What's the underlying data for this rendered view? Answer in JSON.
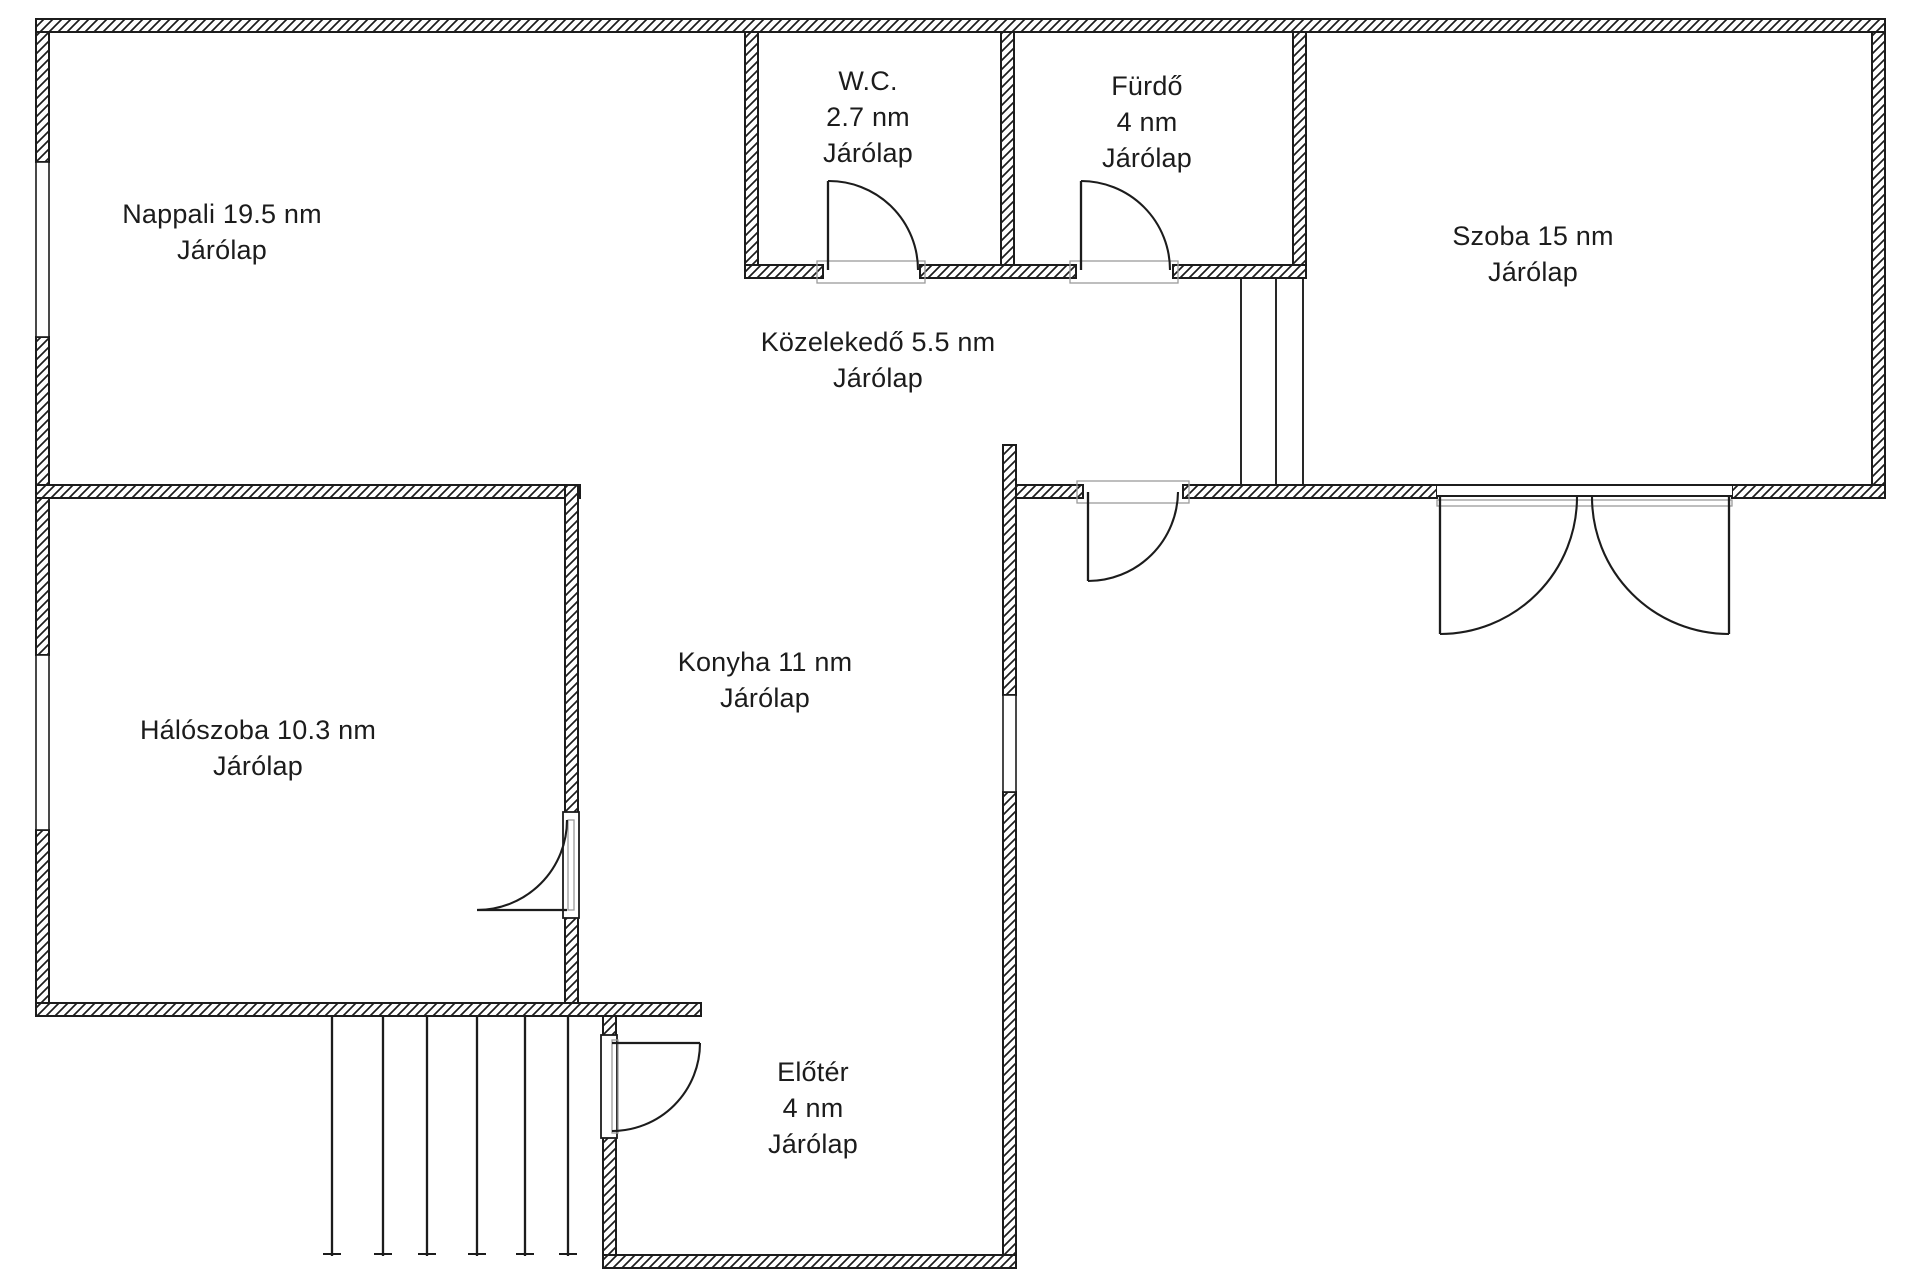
{
  "page": {
    "background": "#ffffff"
  },
  "colors": {
    "line": "#1c1c1c",
    "text": "#1c1c1c",
    "threshold": "#9b9b9b",
    "wall_fill": "#ffffff"
  },
  "rooms": [
    {
      "id": "nappali",
      "lines": [
        "Nappali 19.5 nm",
        "Járólap"
      ],
      "cx": 222,
      "cy": 232
    },
    {
      "id": "wc",
      "lines": [
        "W.C.",
        "2.7 nm",
        "Járólap"
      ],
      "cx": 868,
      "cy": 117
    },
    {
      "id": "furdo",
      "lines": [
        "Fürdő",
        "4 nm",
        "Járólap"
      ],
      "cx": 1147,
      "cy": 122
    },
    {
      "id": "szoba",
      "lines": [
        "Szoba 15 nm",
        "Járólap"
      ],
      "cx": 1533,
      "cy": 254
    },
    {
      "id": "kozelekedo",
      "lines": [
        "Közelekedő 5.5 nm",
        "Járólap"
      ],
      "cx": 878,
      "cy": 360
    },
    {
      "id": "konyha",
      "lines": [
        "Konyha 11 nm",
        "Járólap"
      ],
      "cx": 765,
      "cy": 680
    },
    {
      "id": "haloszoba",
      "lines": [
        "Hálószoba 10.3 nm",
        "Járólap"
      ],
      "cx": 258,
      "cy": 748
    },
    {
      "id": "eloter",
      "lines": [
        "Előtér",
        "4 nm",
        "Járólap"
      ],
      "cx": 813,
      "cy": 1108
    }
  ],
  "geometry": {
    "canvas": {
      "w": 1911,
      "h": 1280
    },
    "walls": [
      {
        "name": "top-wall",
        "r": [
          36,
          19,
          1849,
          13
        ]
      },
      {
        "name": "left-wall-a",
        "r": [
          36,
          32,
          13,
          130
        ]
      },
      {
        "name": "left-wall-b",
        "r": [
          36,
          337,
          13,
          318
        ]
      },
      {
        "name": "left-wall-c",
        "r": [
          36,
          830,
          13,
          186
        ]
      },
      {
        "name": "wc-left-wall",
        "r": [
          745,
          32,
          13,
          246
        ]
      },
      {
        "name": "wc-furdo-divider",
        "r": [
          1001,
          32,
          13,
          233
        ]
      },
      {
        "name": "szoba-left-wall",
        "r": [
          1293,
          32,
          13,
          245
        ]
      },
      {
        "name": "right-wall",
        "r": [
          1872,
          32,
          13,
          466
        ]
      },
      {
        "name": "wcfurdo-bottom-a",
        "r": [
          745,
          265,
          78,
          13
        ]
      },
      {
        "name": "wcfurdo-bottom-b",
        "r": [
          920,
          265,
          156,
          13
        ]
      },
      {
        "name": "wcfurdo-bottom-c",
        "r": [
          1173,
          265,
          133,
          13
        ]
      },
      {
        "name": "nappali-bottom-wall",
        "r": [
          36,
          485,
          544,
          13
        ]
      },
      {
        "name": "corridor-bottom-a",
        "r": [
          1003,
          485,
          80,
          13
        ]
      },
      {
        "name": "corridor-bottom-b",
        "r": [
          1183,
          485,
          254,
          13
        ]
      },
      {
        "name": "corridor-bottom-c",
        "r": [
          1732,
          485,
          153,
          13
        ]
      },
      {
        "name": "konyha-right-a",
        "r": [
          1003,
          445,
          13,
          250
        ]
      },
      {
        "name": "konyha-right-b",
        "r": [
          1003,
          792,
          13,
          463
        ]
      },
      {
        "name": "halo-divider-a",
        "r": [
          565,
          485,
          13,
          330
        ]
      },
      {
        "name": "halo-divider-b",
        "r": [
          565,
          915,
          13,
          101
        ]
      },
      {
        "name": "halo-bottom-wall",
        "r": [
          36,
          1003,
          665,
          13
        ]
      },
      {
        "name": "eloter-left-a",
        "r": [
          603,
          1016,
          13,
          22
        ]
      },
      {
        "name": "eloter-left-b",
        "r": [
          603,
          1135,
          13,
          120
        ]
      },
      {
        "name": "eloter-bottom-wall",
        "r": [
          603,
          1255,
          413,
          13
        ]
      }
    ],
    "windows": [
      {
        "name": "nappali-window",
        "r": [
          36,
          162,
          13,
          175
        ]
      },
      {
        "name": "haloszoba-window",
        "r": [
          36,
          655,
          13,
          175
        ]
      },
      {
        "name": "konyha-window",
        "r": [
          1003,
          695,
          13,
          97
        ]
      }
    ],
    "opening_bands": [
      {
        "name": "szoba-double-door-opening",
        "r": [
          1437,
          484,
          295,
          13
        ]
      }
    ],
    "jambs": [
      {
        "name": "haloszoba-door-jamb",
        "r": [
          563,
          812,
          16,
          106
        ]
      },
      {
        "name": "eloter-door-jamb",
        "r": [
          601,
          1035,
          16,
          103
        ]
      }
    ],
    "thresholds": [
      {
        "name": "wc-door-threshold",
        "r": [
          817,
          261,
          108,
          22
        ]
      },
      {
        "name": "furdo-door-threshold",
        "r": [
          1070,
          261,
          108,
          22
        ]
      },
      {
        "name": "kozelekedo-door-threshold",
        "r": [
          1077,
          481,
          112,
          22
        ]
      },
      {
        "name": "double-door-threshold",
        "r": [
          1437,
          500,
          295,
          6
        ]
      },
      {
        "name": "haloszoba-door-ghost",
        "r": [
          568,
          820,
          6,
          90
        ]
      },
      {
        "name": "eloter-door-ghost",
        "r": [
          612,
          1040,
          6,
          93
        ]
      }
    ],
    "passage_lines": [
      {
        "name": "szoba-passage-line",
        "l": [
          1241,
          277,
          1241,
          485
        ]
      },
      {
        "name": "szoba-passage-line",
        "l": [
          1276,
          277,
          1276,
          485
        ]
      },
      {
        "name": "szoba-passage-line",
        "l": [
          1303,
          277,
          1303,
          485
        ]
      }
    ],
    "stairs": {
      "xs": [
        332,
        383,
        427,
        477,
        525,
        568
      ],
      "y1": 1016,
      "y2": 1256,
      "tick_half": 9
    },
    "doors": [
      {
        "name": "wc-door",
        "leaf": [
          828,
          270,
          828,
          181
        ],
        "arc": [
          828,
          181,
          918,
          270
        ],
        "r": 89,
        "sweep": 1
      },
      {
        "name": "furdo-door",
        "leaf": [
          1081,
          270,
          1081,
          181
        ],
        "arc": [
          1081,
          181,
          1170,
          270
        ],
        "r": 89,
        "sweep": 1
      },
      {
        "name": "kozelekedo-door",
        "leaf": [
          1088,
          492,
          1088,
          581
        ],
        "arc": [
          1178,
          492,
          1088,
          581
        ],
        "r": 90,
        "sweep": 1
      },
      {
        "name": "haloszoba-door",
        "leaf": [
          567,
          910,
          477,
          910
        ],
        "arc": [
          477,
          910,
          567,
          820
        ],
        "r": 90,
        "sweep": 0
      },
      {
        "name": "eloter-door",
        "leaf": [
          612,
          1043,
          700,
          1043
        ],
        "arc": [
          700,
          1043,
          612,
          1131
        ],
        "r": 88,
        "sweep": 1
      },
      {
        "name": "szoba-double-door-left",
        "leaf": [
          1440,
          497,
          1440,
          634
        ],
        "arc": [
          1440,
          634,
          1577,
          497
        ],
        "r": 137,
        "sweep": 0
      },
      {
        "name": "szoba-double-door-right",
        "leaf": [
          1729,
          497,
          1729,
          634
        ],
        "arc": [
          1729,
          634,
          1592,
          497
        ],
        "r": 137,
        "sweep": 1
      }
    ]
  }
}
